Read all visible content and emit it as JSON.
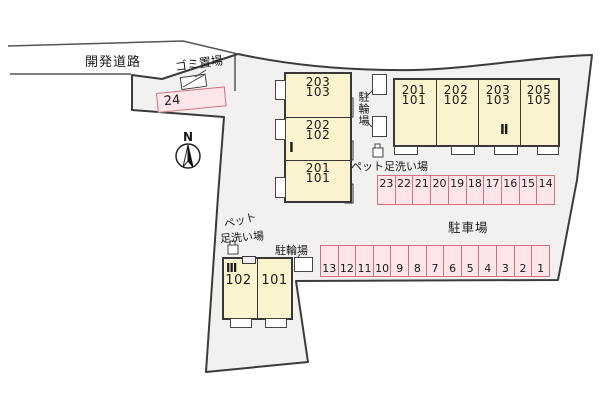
{
  "site": {
    "road_label": "開発道路",
    "garbage_label": "ゴミ置場",
    "parking_lot_label": "駐車場",
    "north_label": "N",
    "colors": {
      "site_fill": "#f2f1f0",
      "boundary": "#3b3b3b",
      "building_fill": "#fbf3ce",
      "parking_fill": "#fce6ea",
      "parking_border": "#d4717e"
    }
  },
  "buildings": {
    "one": {
      "name": "Ⅰ",
      "units": [
        {
          "upper": "203",
          "lower": "103"
        },
        {
          "upper": "202",
          "lower": "102"
        },
        {
          "upper": "201",
          "lower": "101"
        }
      ]
    },
    "two": {
      "name": "Ⅱ",
      "units": [
        {
          "upper": "201",
          "lower": "101"
        },
        {
          "upper": "202",
          "lower": "102"
        },
        {
          "upper": "203",
          "lower": "103"
        },
        {
          "upper": "205",
          "lower": "105"
        }
      ]
    },
    "three": {
      "name": "Ⅲ",
      "units": [
        {
          "upper": "102"
        },
        {
          "upper": "101"
        }
      ]
    }
  },
  "parking": {
    "space_24": "24",
    "row_upper": [
      "23",
      "22",
      "21",
      "20",
      "19",
      "18",
      "17",
      "16",
      "15",
      "14"
    ],
    "row_lower": [
      "13",
      "12",
      "11",
      "10",
      "9",
      "8",
      "7",
      "6",
      "5",
      "4",
      "3",
      "2",
      "1"
    ]
  },
  "bike_parking": {
    "label_mid": "駐輪場",
    "label_bottom": "駐輪場"
  },
  "pet_wash": {
    "label_mid": "ペット足洗い場",
    "label_bottom_line1": "ペット",
    "label_bottom_line2": "足洗い場"
  }
}
